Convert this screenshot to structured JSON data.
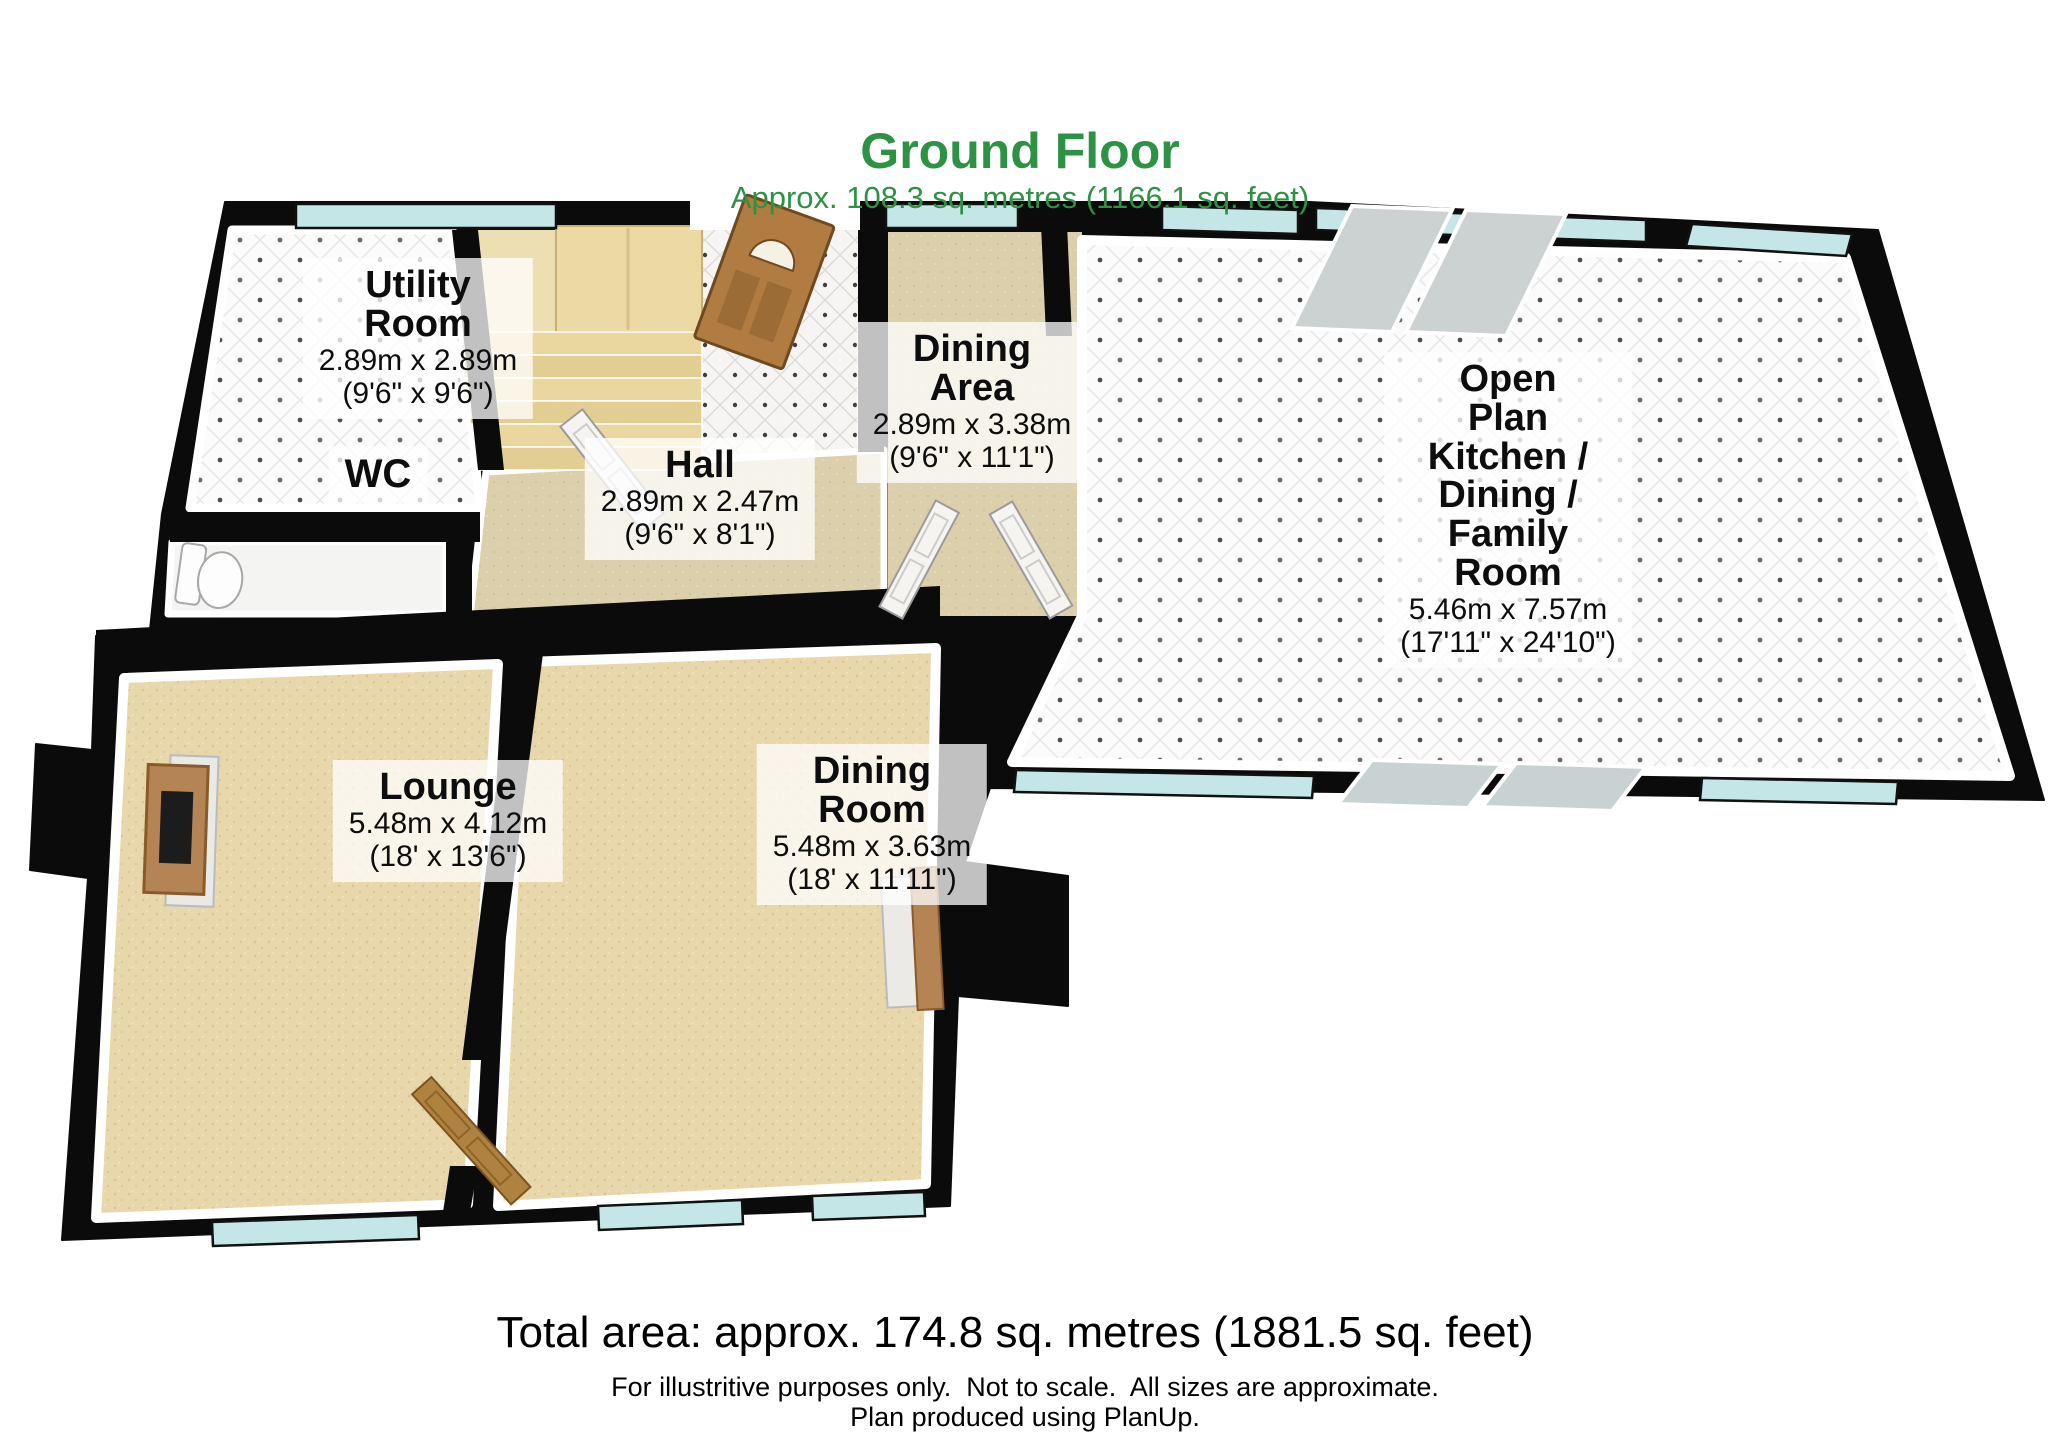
{
  "title": {
    "text": "Ground Floor",
    "subtitle": "Approx. 108.3 sq. metres (1166.1 sq. feet)"
  },
  "rooms": {
    "utility": {
      "name": "Utility\nRoom",
      "dims_metric": "2.89m x 2.89m",
      "dims_imperial": "(9'6\" x 9'6\")"
    },
    "wc": {
      "name": "WC"
    },
    "hall": {
      "name": "Hall",
      "dims_metric": "2.89m x 2.47m",
      "dims_imperial": "(9'6\" x 8'1\")"
    },
    "dining_area": {
      "name": "Dining\nArea",
      "dims_metric": "2.89m x 3.38m",
      "dims_imperial": "(9'6\" x 11'1\")"
    },
    "open_plan": {
      "name": "Open\nPlan\nKitchen /\nDining /\nFamily\nRoom",
      "dims_metric": "5.46m x 7.57m",
      "dims_imperial": "(17'11\" x 24'10\")"
    },
    "lounge": {
      "name": "Lounge",
      "dims_metric": "5.48m x 4.12m",
      "dims_imperial": "(18' x 13'6\")"
    },
    "dining_room": {
      "name": "Dining\nRoom",
      "dims_metric": "5.48m x 3.63m",
      "dims_imperial": "(18' x 11'11\")"
    }
  },
  "footer": {
    "total_area": "Total area: approx. 174.8 sq. metres (1881.5 sq. feet)",
    "disclaimer": "For illustritive purposes only.  Not to scale.  All sizes are approximate.",
    "produced": "Plan produced using PlanUp."
  },
  "colors": {
    "title_green": "#2e9245",
    "wall_black": "#0b0b0b",
    "window_teal": "#c4e6e6",
    "carpet_tan": "#e8d7ab",
    "hall_beige": "#dbcfac",
    "door_wood": "#b07c42",
    "skylight_grey": "#ccd2d2"
  }
}
